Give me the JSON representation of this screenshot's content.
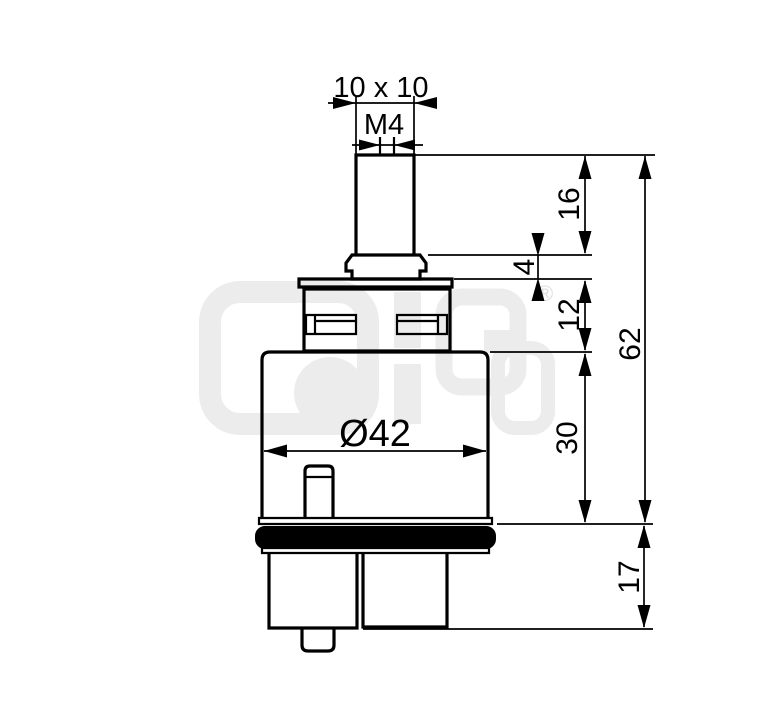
{
  "labels": {
    "stem_cross_section": "10 x 10",
    "thread": "M4",
    "stem_height": "16",
    "collar_height": "4",
    "clip_section_height": "12",
    "overall_height": "62",
    "body_diameter": "Ø42",
    "body_height": "30",
    "foot_height": "17"
  },
  "watermark": {
    "registered_mark": "®"
  },
  "colors": {
    "line": "#000000",
    "watermark": "#ececec",
    "background": "#ffffff"
  }
}
